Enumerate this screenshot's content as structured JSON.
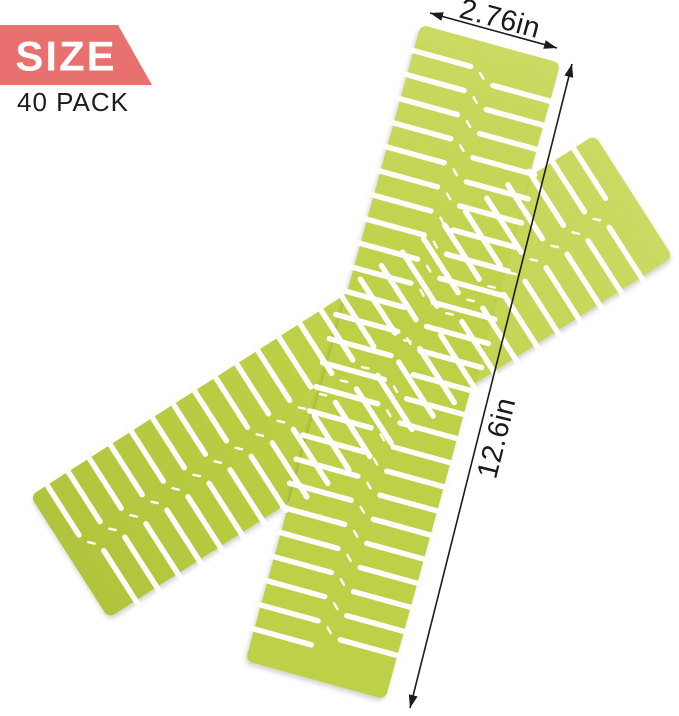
{
  "badge": {
    "size_label": "SIZE",
    "pack_label": "40 PACK",
    "bg_color": "#e8716f",
    "size_text_color": "#ffffff",
    "pack_text_color": "#1d1d1d"
  },
  "annotations": {
    "width_label": "2.76in",
    "length_label": "12.6in",
    "line_color": "#1c1c1c",
    "text_color": "#1a1a1a"
  },
  "product": {
    "description": "two crossed slotted plastic drawer-divider strips",
    "body_color": "#bdd046",
    "body_color_light": "#ccd963",
    "body_color_dark": "#b1c43c",
    "slot_color": "#fdfdfb"
  }
}
